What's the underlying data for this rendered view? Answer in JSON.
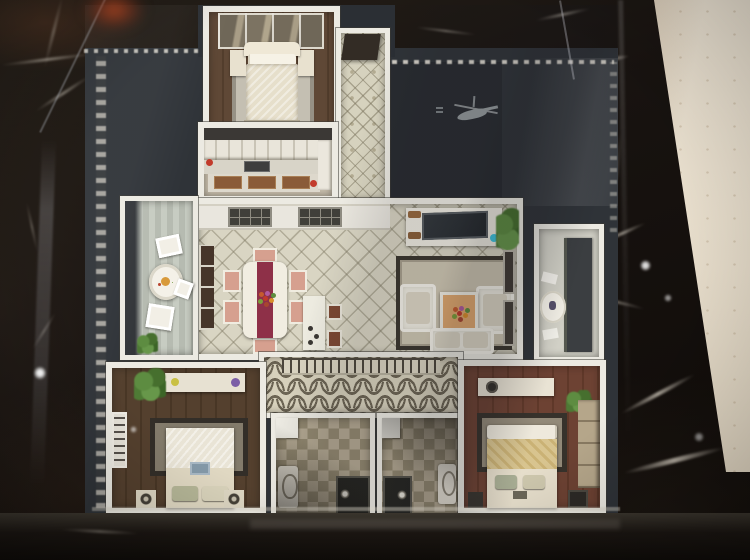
{
  "scene": {
    "type": "photograph",
    "subject": "Top-down photo of an architectural scale model of an apartment floor plan displayed under a glass case on a black marble coffee table",
    "aria": {
      "stage": "Photograph of an apartment scale model on a black marble table",
      "table": "Black marble table with white veining",
      "floor_wedge": "Beige room floor visible beyond the right edge of the table",
      "model": "Apartment floor-plan scale model on dark charcoal base",
      "glass": "Glass display case reflections",
      "silhouette": "Gray helicopter-like reflection silhouette on the dark base",
      "orange": "Blurred orange reflection at the top left edge"
    },
    "palette": {
      "marble_dark": "#16110d",
      "marble_vein": "#e4dcce",
      "room_floor_beige": "#e9e0d0",
      "model_base": "#2f3338",
      "wall_white": "#eceae2",
      "tile_beige": "#d9d5c3",
      "wood_dark_brown": "#54402e",
      "wood_red_brown": "#6d4233",
      "runner_red": "#8e3048",
      "chair_pink": "#d6a08f",
      "accent_cyan": "#3ec3dd",
      "accent_purple": "#7b5ea6",
      "plant_green": "#55823c",
      "tv_screen": "#2b3034",
      "bathroom_tile_a": "#b2a791",
      "bathroom_tile_b": "#91876f"
    },
    "rooms": [
      {
        "id": "master-bedroom",
        "label": "Master bedroom with cream double bed, two nightstands and mirrored wardrobe on dark wood floor"
      },
      {
        "id": "entry-corridor",
        "label": "Entry corridor with diamond-pattern tile and dark entrance door"
      },
      {
        "id": "kitchen",
        "label": "Kitchen with white upper cabinets, counter appliances and wood-front lower cabinets"
      },
      {
        "id": "dining-living-room",
        "label": "Open dining and living room with diamond tile floor"
      },
      {
        "id": "left-balcony",
        "label": "Left balcony with round breakfast table, white chairs and plant"
      },
      {
        "id": "right-balcony",
        "label": "Right balcony with small round table"
      },
      {
        "id": "hallway",
        "label": "Hallway with ogee-arch patterned floor and balustrade"
      },
      {
        "id": "bedroom-2",
        "label": "Lower-left bedroom with white bed, dresser and plant on dark wood floor"
      },
      {
        "id": "bathroom-1",
        "label": "Bathroom with checkered tile floor, toilet and dark shower"
      },
      {
        "id": "bathroom-2",
        "label": "Second bathroom with checkered tile floor, toilet and dark shower"
      },
      {
        "id": "bedroom-3",
        "label": "Lower-right bedroom with yellow-cream bed and wardrobe on red-brown wood floor"
      }
    ],
    "furniture": {
      "dining_table": "White dining table with dark red runner, flower centerpiece and six pink chairs",
      "island": "White kitchen island with two brown bar stools",
      "tv_wall": "White TV console with dark flat screen and cyan accent",
      "living_set": "Two white armchairs, white sofa, wood-top coffee table with flowers on bordered rug"
    }
  }
}
